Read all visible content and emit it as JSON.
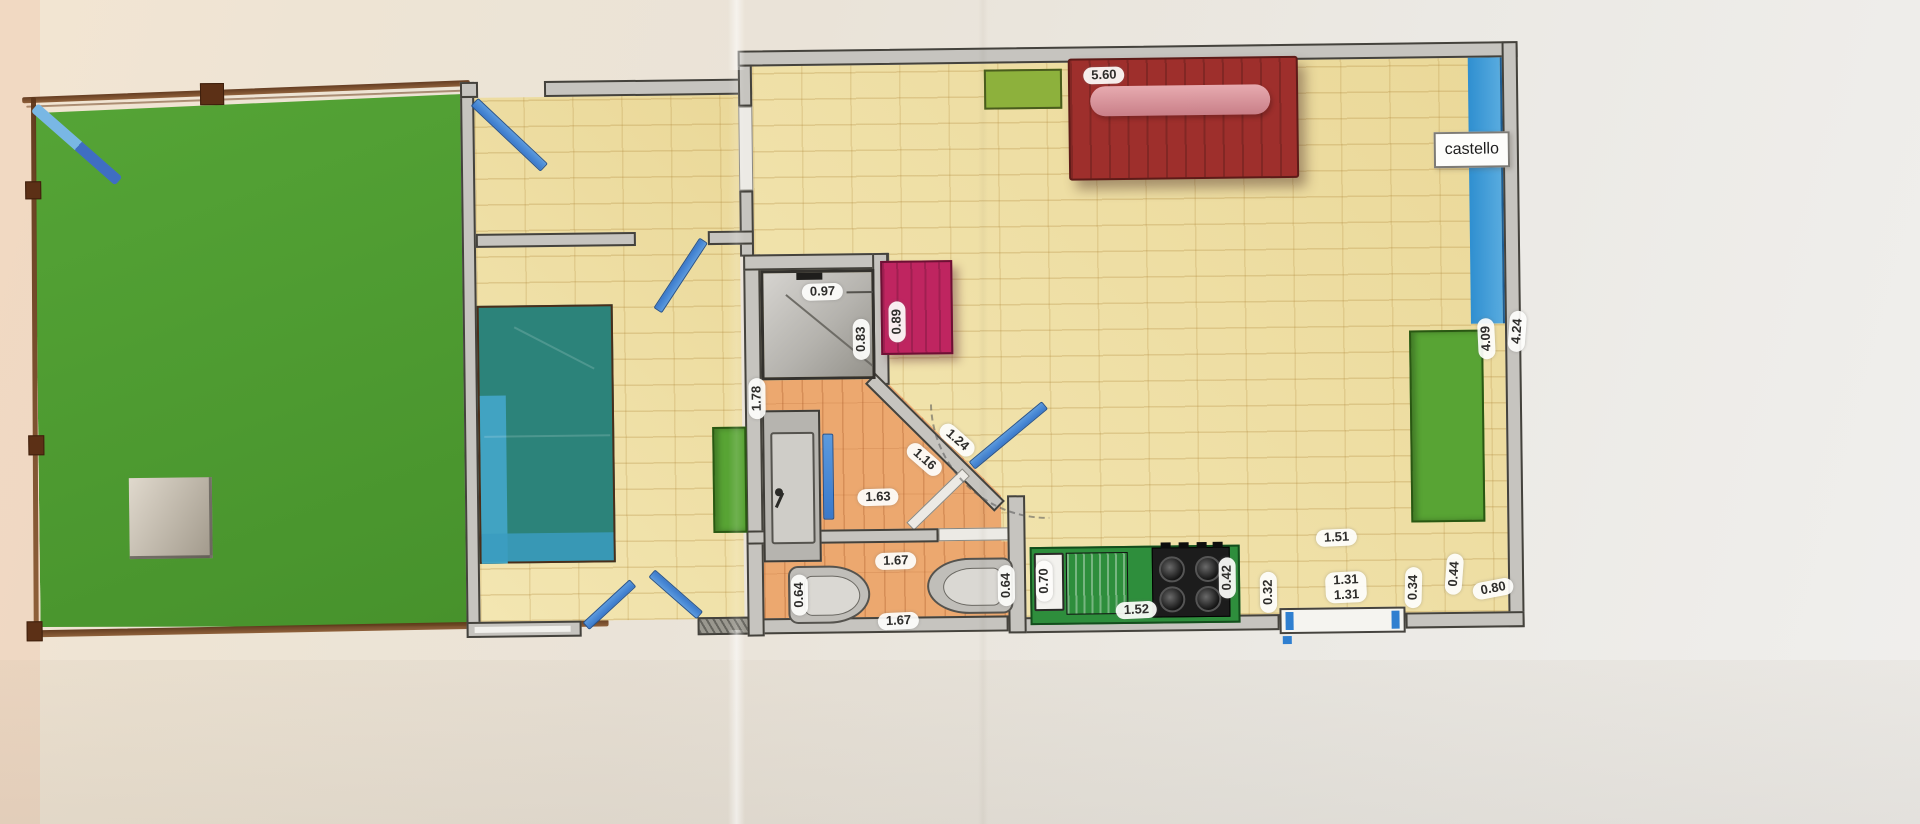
{
  "plan_label": {
    "castello": "castello"
  },
  "measurements": [
    {
      "value": "5.60"
    },
    {
      "value": "0.97"
    },
    {
      "value": "0.83"
    },
    {
      "value": "0.89"
    },
    {
      "value": "1.78"
    },
    {
      "value": "1.16"
    },
    {
      "value": "1.24"
    },
    {
      "value": "1.63"
    },
    {
      "value": "1.67"
    },
    {
      "value": "0.64"
    },
    {
      "value": "0.64"
    },
    {
      "value": "1.67"
    },
    {
      "value": "0.70"
    },
    {
      "value": "1.52"
    },
    {
      "value": "0.42"
    },
    {
      "value": "0.32"
    },
    {
      "value": "1.51"
    },
    {
      "value": "1.31\n1.31"
    },
    {
      "value": "0.34"
    },
    {
      "value": "0.44"
    },
    {
      "value": "0.80"
    },
    {
      "value": "4.09"
    },
    {
      "value": "4.24"
    }
  ]
}
